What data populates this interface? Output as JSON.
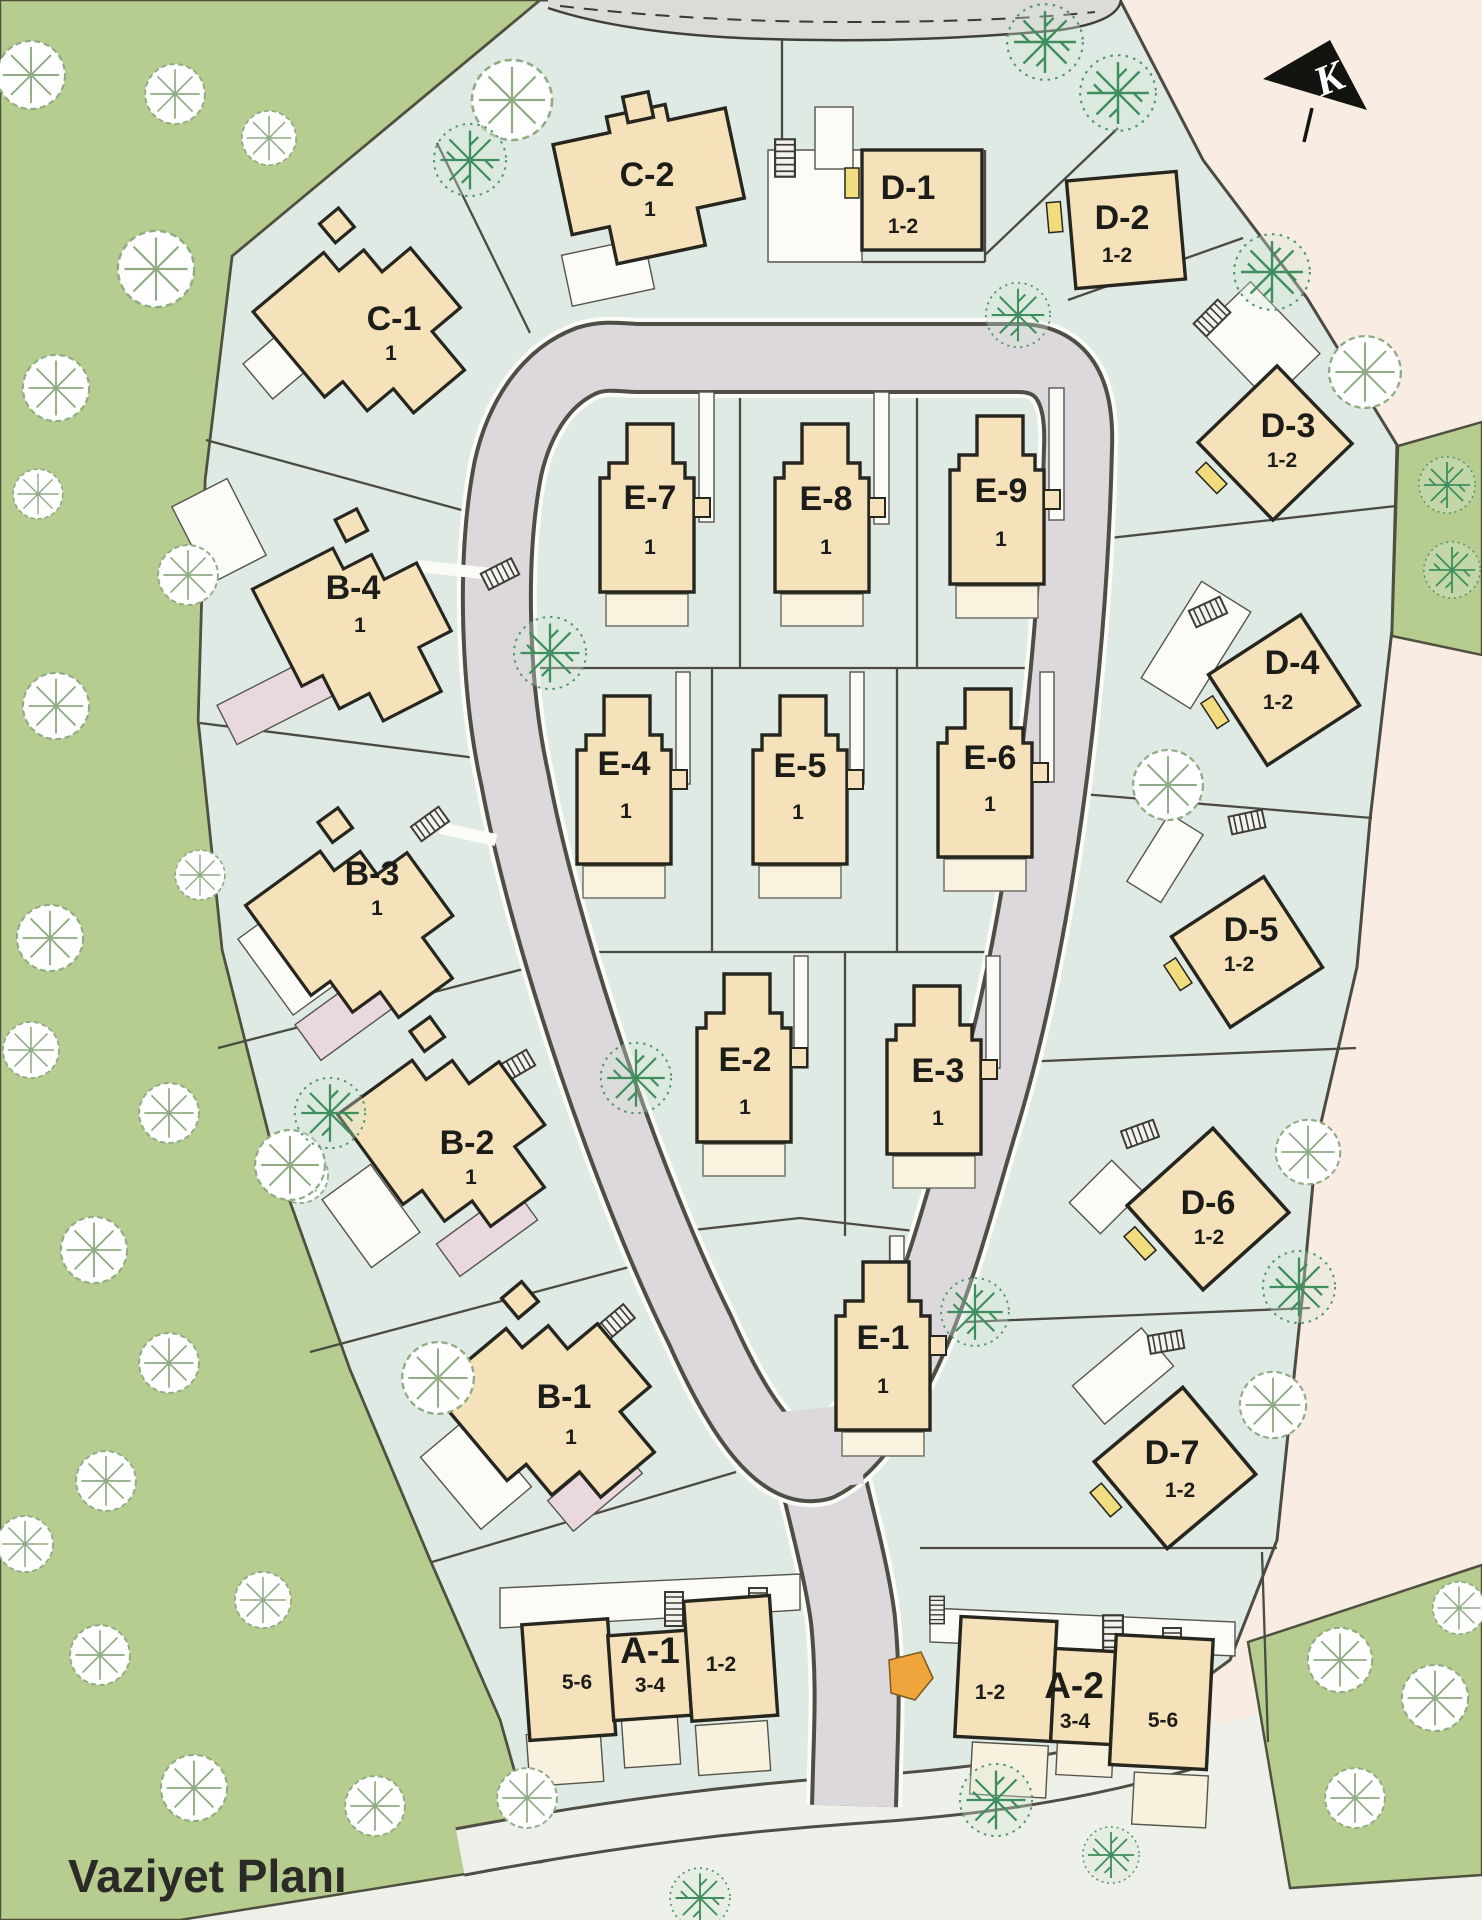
{
  "title": "Vaziyet Planı",
  "north_label": "K",
  "buildings": {
    "a1": {
      "label": "A-1",
      "units": [
        "5-6",
        "3-4",
        "1-2"
      ]
    },
    "a2": {
      "label": "A-2",
      "units": [
        "1-2",
        "3-4",
        "5-6"
      ]
    },
    "b1": {
      "label": "B-1",
      "unit": "1"
    },
    "b2": {
      "label": "B-2",
      "unit": "1"
    },
    "b3": {
      "label": "B-3",
      "unit": "1"
    },
    "b4": {
      "label": "B-4",
      "unit": "1"
    },
    "c1": {
      "label": "C-1",
      "unit": "1"
    },
    "c2": {
      "label": "C-2",
      "unit": "1"
    },
    "d1": {
      "label": "D-1",
      "unit": "1-2"
    },
    "d2": {
      "label": "D-2",
      "unit": "1-2"
    },
    "d3": {
      "label": "D-3",
      "unit": "1-2"
    },
    "d4": {
      "label": "D-4",
      "unit": "1-2"
    },
    "d5": {
      "label": "D-5",
      "unit": "1-2"
    },
    "d6": {
      "label": "D-6",
      "unit": "1-2"
    },
    "d7": {
      "label": "D-7",
      "unit": "1-2"
    },
    "e1": {
      "label": "E-1",
      "unit": "1"
    },
    "e2": {
      "label": "E-2",
      "unit": "1"
    },
    "e3": {
      "label": "E-3",
      "unit": "1"
    },
    "e4": {
      "label": "E-4",
      "unit": "1"
    },
    "e5": {
      "label": "E-5",
      "unit": "1"
    },
    "e6": {
      "label": "E-6",
      "unit": "1"
    },
    "e7": {
      "label": "E-7",
      "unit": "1"
    },
    "e8": {
      "label": "E-8",
      "unit": "1"
    },
    "e9": {
      "label": "E-9",
      "unit": "1"
    }
  },
  "colors": {
    "site": "#dfeae4",
    "park_green": "#b7cd90",
    "outside_pink": "#f8ece3",
    "road_gray": "#dcd8db",
    "building_cream": "#f6e2ba",
    "patio_cream": "#f9f2de",
    "patio_pink": "#ead8df",
    "marker_yellow": "#f2dd7e",
    "marker_orange": "#f0a43c",
    "line_dark": "#3f3f37"
  }
}
